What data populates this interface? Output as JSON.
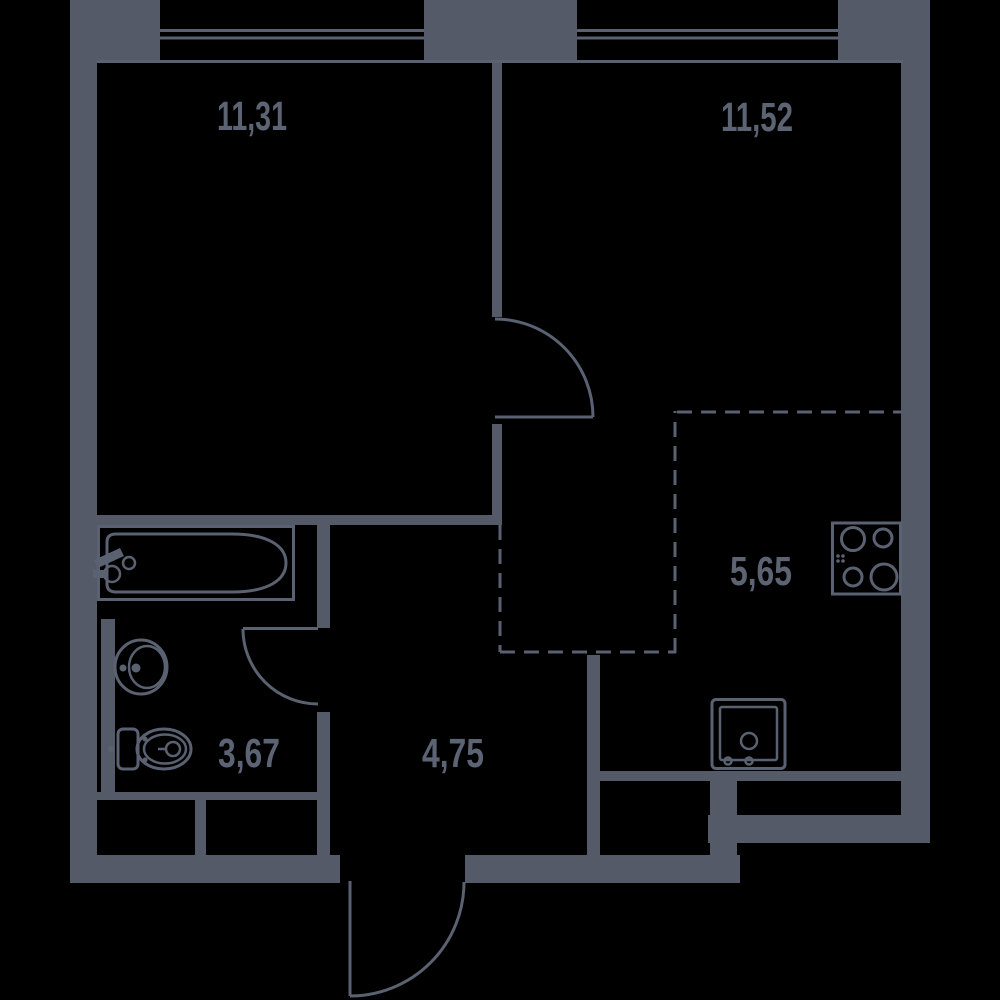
{
  "theme": {
    "background": "#000000",
    "wall": "#545a67",
    "line": "#5a6170",
    "label": "#5c6373"
  },
  "plan": {
    "type": "apartment-floor-plan",
    "rooms": [
      {
        "id": "room-top-left",
        "area_label": "11,31"
      },
      {
        "id": "room-top-right",
        "area_label": "11,52"
      },
      {
        "id": "bathroom",
        "area_label": "3,67"
      },
      {
        "id": "hallway",
        "area_label": "4,75"
      },
      {
        "id": "kitchen-zone",
        "area_label": "5,65"
      }
    ],
    "fixture_icons": [
      "window-icon",
      "door-swing-icon",
      "bathtub-icon",
      "bathtub-faucet-icon",
      "washbasin-icon",
      "toilet-icon",
      "kitchen-sink-icon",
      "stove-icon"
    ]
  }
}
